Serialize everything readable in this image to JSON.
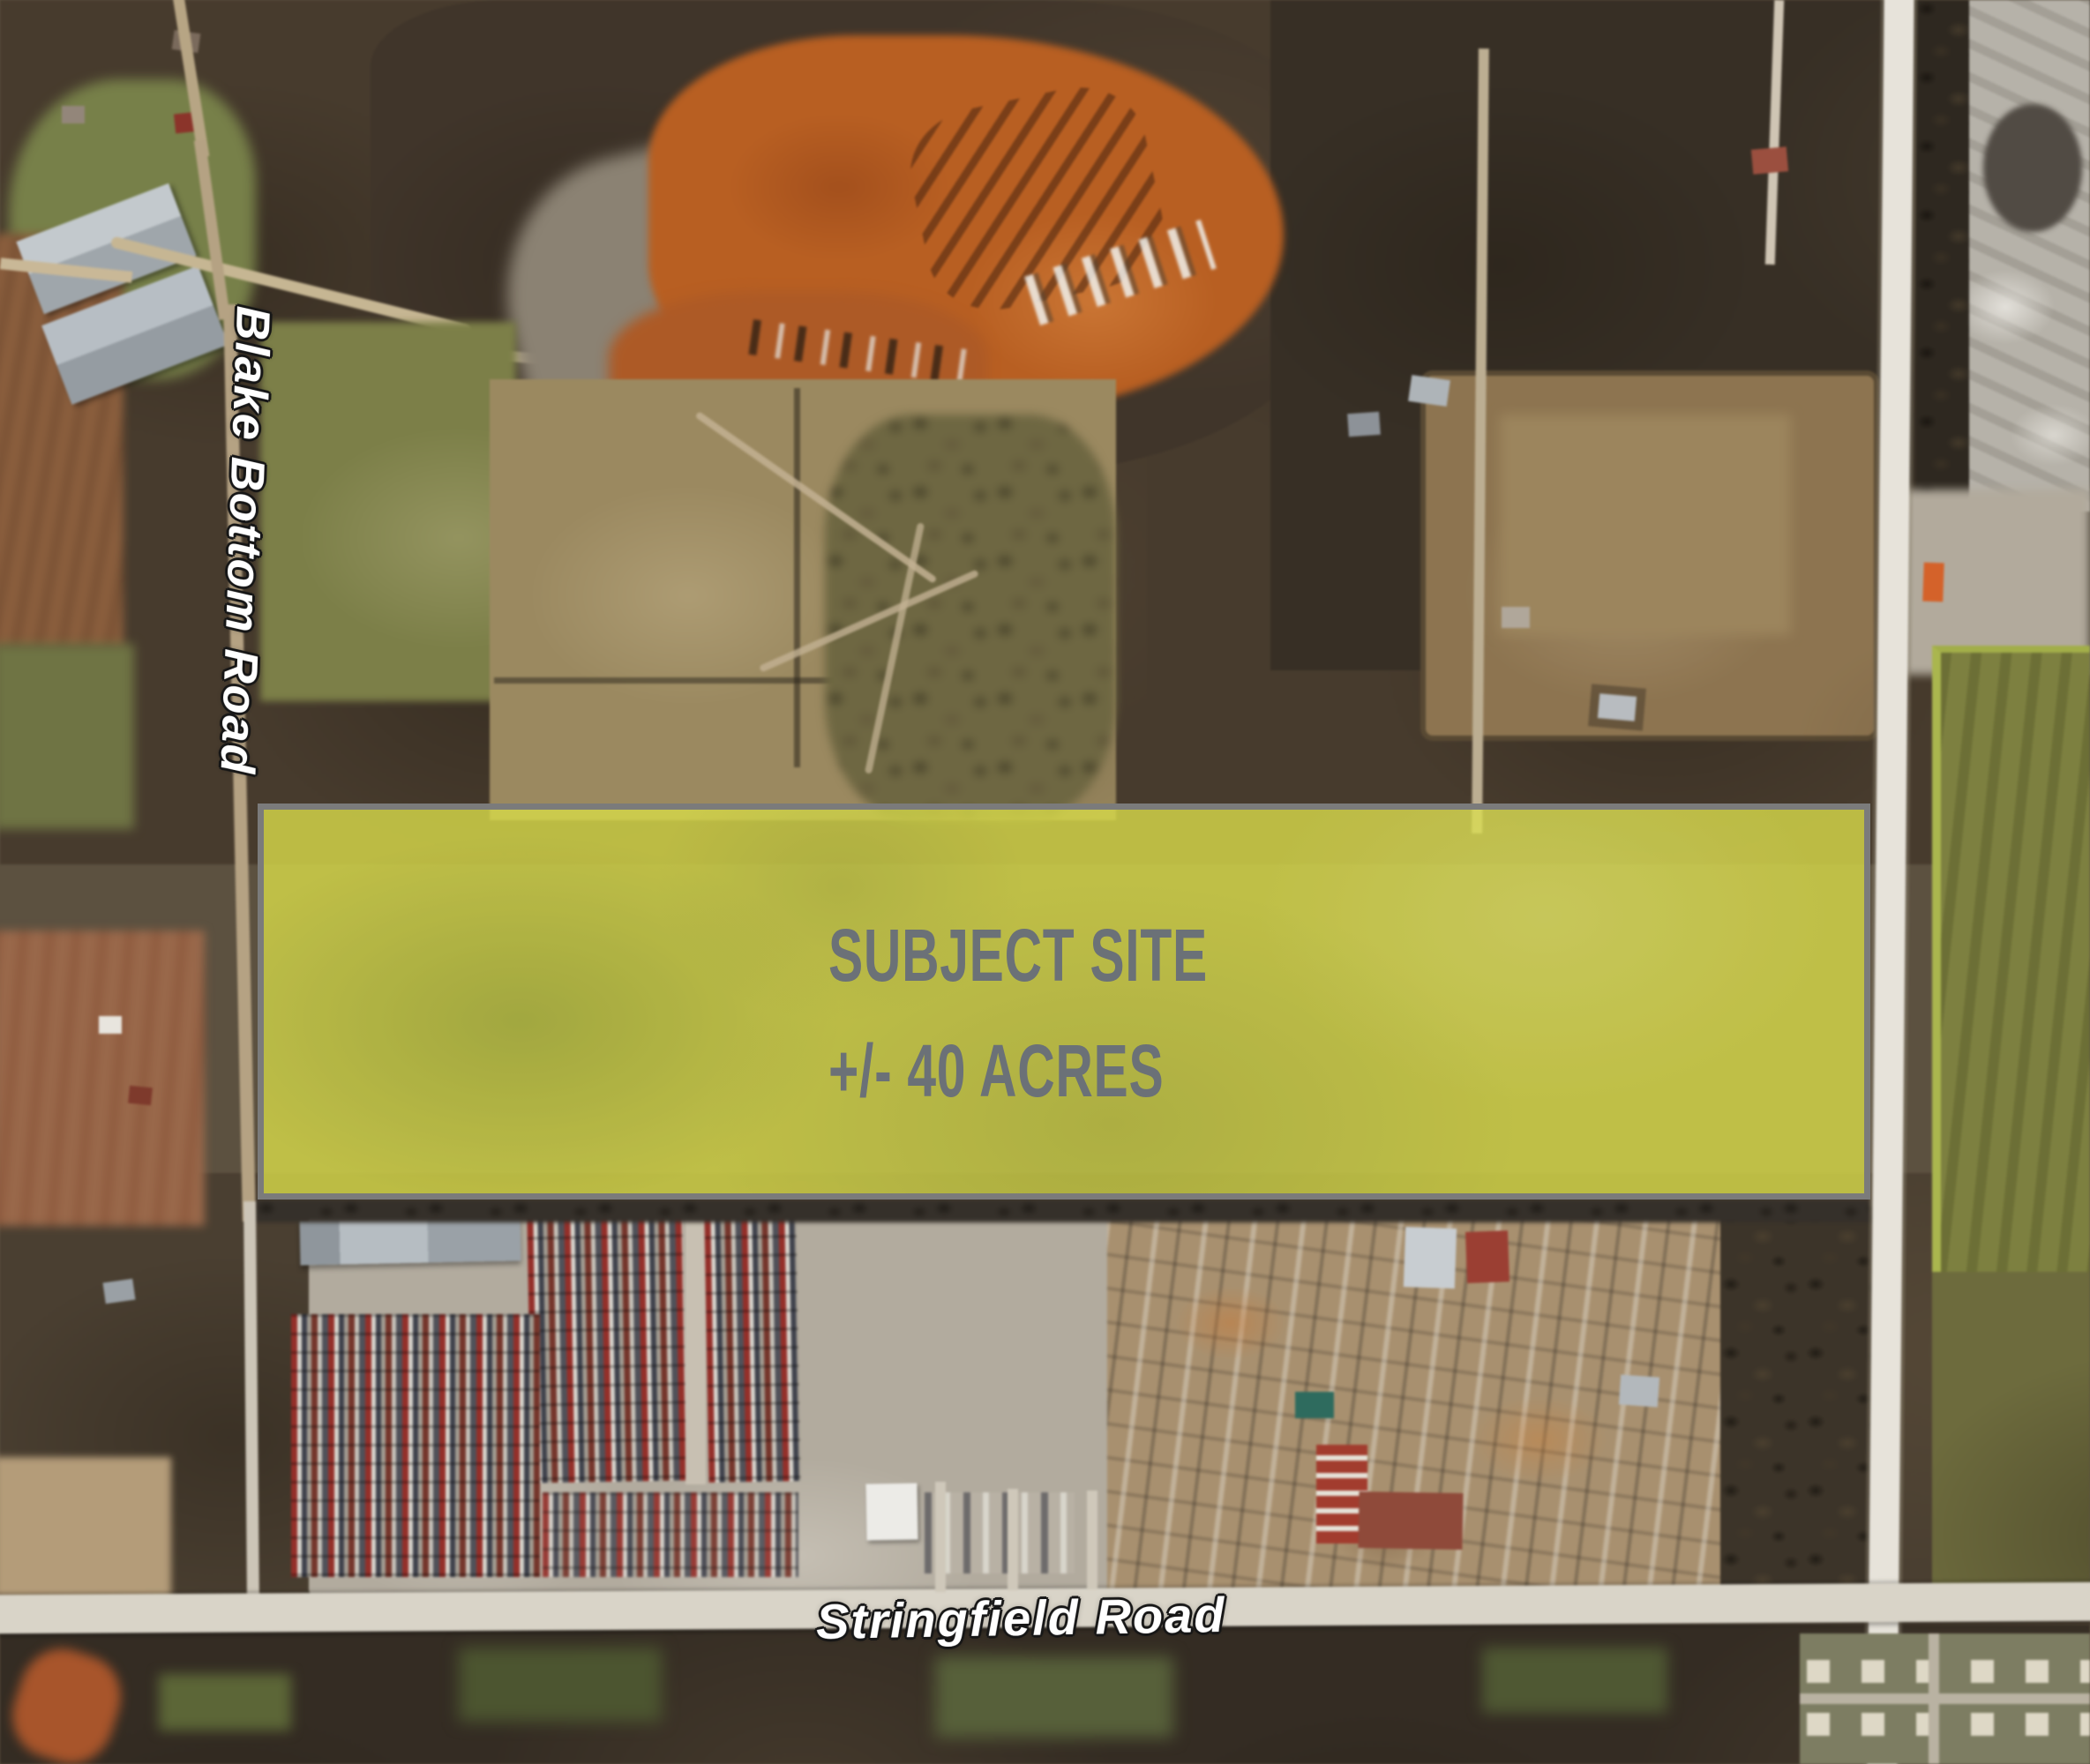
{
  "map": {
    "type": "aerial-satellite-photo"
  },
  "site": {
    "title": "SUBJECT SITE",
    "acreage": "+/- 40 ACRES"
  },
  "roads": {
    "blake_bottom": "Blake Bottom Road",
    "stringfield": "Stringfield Road"
  },
  "colors": {
    "site_fill": "#d6d84a",
    "site_border": "#7b7b7b",
    "site_text": "#6b7177",
    "road_label_fill": "#ffffff",
    "road_label_outline": "#161616"
  }
}
